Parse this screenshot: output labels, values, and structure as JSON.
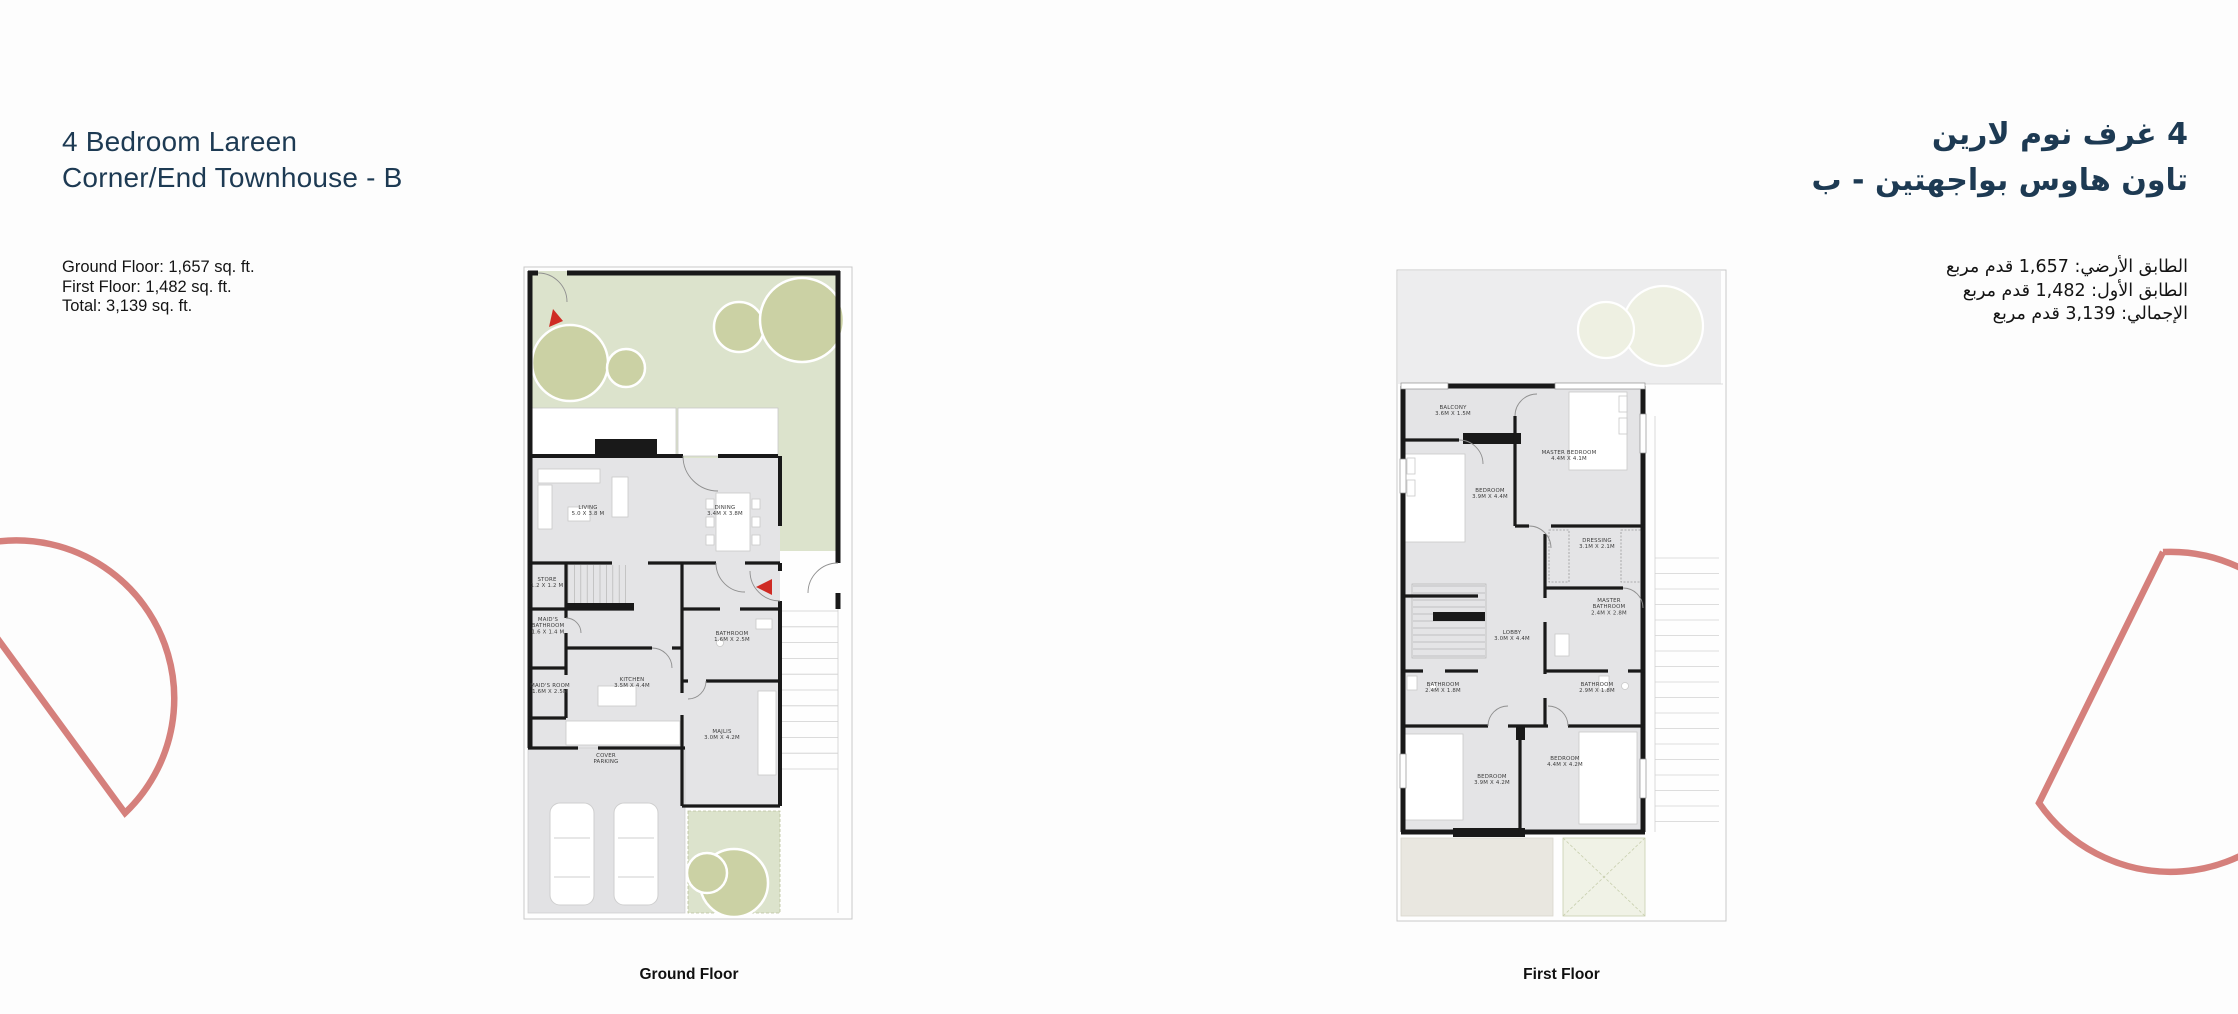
{
  "colors": {
    "navy": "#1d3a53",
    "text": "#141414",
    "arc_salmon": "#d5807c",
    "garden_green": "#dce3cc",
    "tree_green": "#cbd1a4",
    "tree_faded": "#eef0e2",
    "floor_gray": "#e4e4e6",
    "wall_black": "#191919",
    "arrow_red": "#cf2b24"
  },
  "header_left": {
    "title_line1": "4 Bedroom Lareen",
    "title_line2": "Corner/End Townhouse - B",
    "area_lines": [
      "Ground Floor:  1,657 sq. ft.",
      "First Floor:  1,482 sq. ft.",
      "Total:  3,139  sq. ft."
    ]
  },
  "header_right": {
    "title_line1": "4 غرف نوم لارين",
    "title_line2": "تاون هاوس بواجهتين  -  ب",
    "area_lines": [
      "الطابق الأرضي:  1,657 قدم مربع",
      "الطابق الأول:  1,482 قدم مربع",
      "الإجمالي:  3,139 قدم مربع"
    ]
  },
  "plans": {
    "ground": {
      "caption": "Ground Floor",
      "rooms": [
        {
          "n1": "LIVING",
          "d": "5.0 X 3.8 M",
          "x": 68,
          "y": 246
        },
        {
          "n1": "DINING",
          "d": "3.4M X 3.8M",
          "x": 205,
          "y": 246
        },
        {
          "n1": "STORE",
          "d": "1.2 X 1.2 M",
          "x": 27,
          "y": 318
        },
        {
          "n1": "MAID'S",
          "n2": "BATHROOM",
          "d": "1.6 X 1.4 M",
          "x": 28,
          "y": 358
        },
        {
          "n1": "MAID'S ROOM",
          "d": "1.6M X 2.5M",
          "x": 30,
          "y": 424
        },
        {
          "n1": "KITCHEN",
          "d": "3.5M X 4.4M",
          "x": 112,
          "y": 418
        },
        {
          "n1": "BATHROOM",
          "d": "1.6M X 2.5M",
          "x": 212,
          "y": 372
        },
        {
          "n1": "MAJLIS",
          "d": "3.0M X 4.2M",
          "x": 202,
          "y": 470
        },
        {
          "n1": "COVER",
          "n2": "PARKING",
          "x": 86,
          "y": 494
        }
      ]
    },
    "first": {
      "caption": "First Floor",
      "rooms": [
        {
          "n1": "BALCONY",
          "d": "3.6M X 1.5M",
          "x": 60,
          "y": 143
        },
        {
          "n1": "MASTER BEDROOM",
          "d": "4.4M X 4.1M",
          "x": 176,
          "y": 188
        },
        {
          "n1": "BEDROOM",
          "d": "3.9M X 4.4M",
          "x": 97,
          "y": 226
        },
        {
          "n1": "DRESSING",
          "d": "3.1M X 2.1M",
          "x": 204,
          "y": 276
        },
        {
          "n1": "MASTER",
          "n2": "BATHROOM",
          "d": "2.4M X 2.8M",
          "x": 216,
          "y": 336
        },
        {
          "n1": "LOBBY",
          "d": "3.0M X 4.4M",
          "x": 119,
          "y": 368
        },
        {
          "n1": "BATHROOM",
          "d": "2.4M X 1.8M",
          "x": 50,
          "y": 420
        },
        {
          "n1": "BATHROOM",
          "d": "2.9M X 1.8M",
          "x": 204,
          "y": 420
        },
        {
          "n1": "BEDROOM",
          "d": "3.9M X 4.2M",
          "x": 99,
          "y": 512
        },
        {
          "n1": "BEDROOM",
          "d": "4.4M X 4.2M",
          "x": 172,
          "y": 494
        }
      ]
    }
  }
}
